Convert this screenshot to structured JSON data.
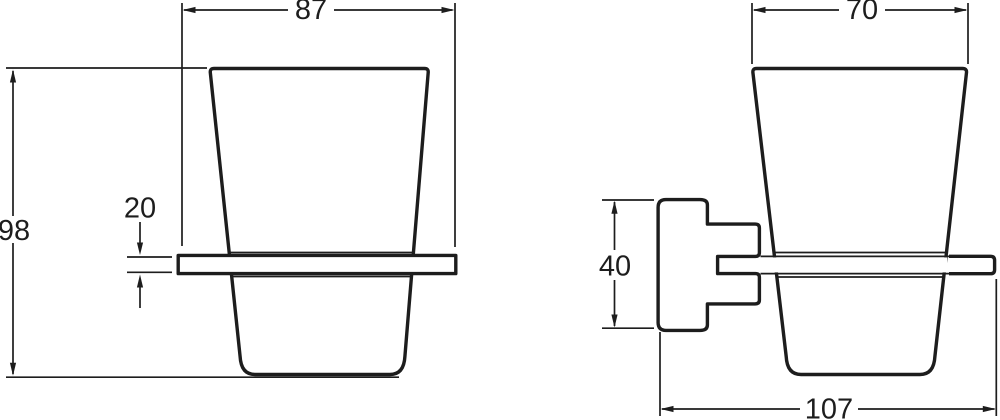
{
  "drawing": {
    "subject": "wall-mounted tumbler holder with glass cup, two orthographic views",
    "background": "#ffffff",
    "line_color": "#1d1d1d",
    "views": {
      "front": {
        "dimensions": {
          "top_width": "87",
          "overall_height": "98",
          "holder_ring_thickness": "20"
        }
      },
      "side": {
        "dimensions": {
          "top_width": "70",
          "wall_plate_height": "40",
          "overall_depth": "107"
        }
      }
    }
  }
}
